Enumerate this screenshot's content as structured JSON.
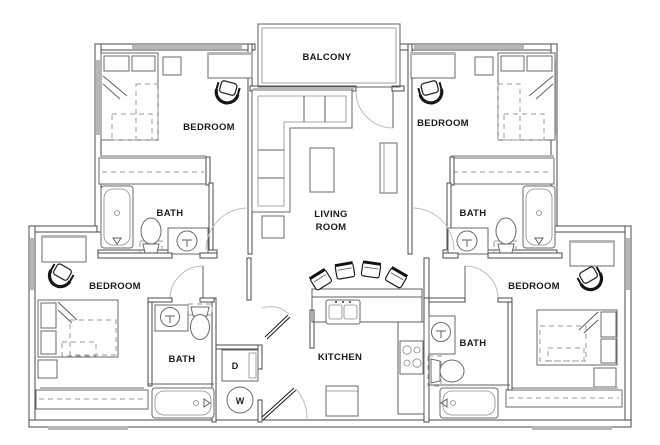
{
  "plan": {
    "balcony_label": "BALCONY",
    "living_room": {
      "line1": "LIVING",
      "line2": "ROOM"
    },
    "kitchen_label": "KITCHEN",
    "bedrooms": {
      "top_left": "BEDROOM",
      "top_right": "BEDROOM",
      "bottom_left": "BEDROOM",
      "bottom_right": "BEDROOM"
    },
    "baths": {
      "top_left": "BATH",
      "top_right": "BATH",
      "bottom_left": "BATH",
      "bottom_right": "BATH"
    },
    "laundry": {
      "dryer": "D",
      "washer": "W"
    }
  },
  "icons": {
    "beds": "bed-icon",
    "desk_chairs": "desk-chair-icon",
    "bar_stools": "bar-stool-icon",
    "toilets": "toilet-icon",
    "sinks": "sink-icon",
    "tubs": "bathtub-icon",
    "sofa": "sofa-icon",
    "stove": "stove-icon",
    "fridge": "fridge-icon",
    "washer": "washer-icon",
    "dryer": "dryer-icon"
  },
  "colors": {
    "background": "#ffffff",
    "wall": "#4a4a4a",
    "furniture_line": "#6a6a6a",
    "window_fill": "#b7b7b7",
    "dark_fixture": "#1a1a1a",
    "text": "#1b1b1b"
  }
}
